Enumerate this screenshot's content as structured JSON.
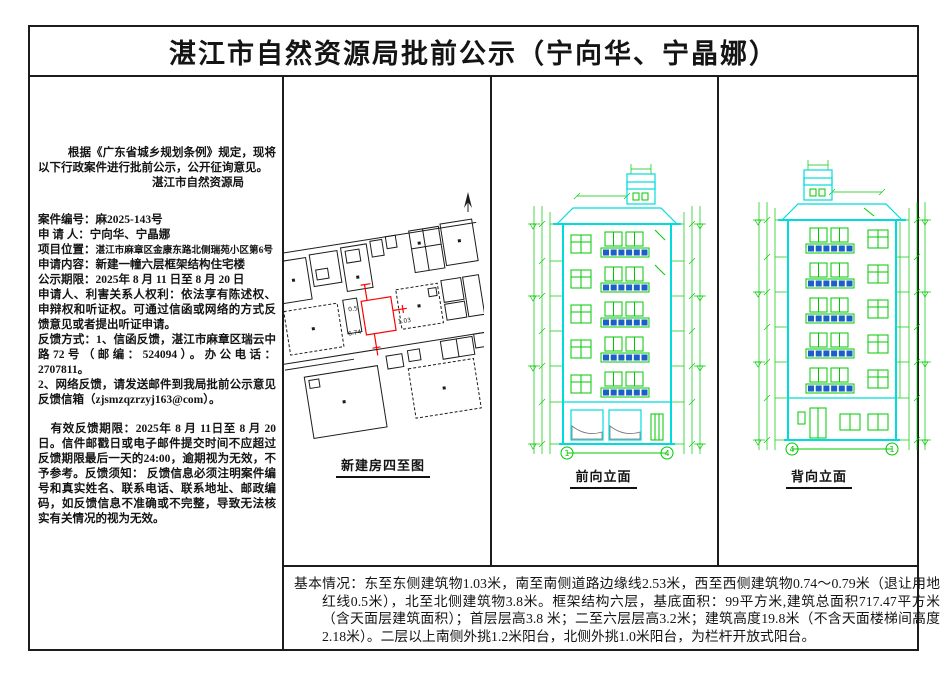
{
  "title": "湛江市自然资源局批前公示（宁向华、宁晶娜）",
  "left_panel": {
    "intro": "根据《广东省城乡规划条例》规定，现将以下行政案件进行批前公示，公开征询意见。",
    "agency": "湛江市自然资源局",
    "fields": [
      {
        "label": "案件编号：",
        "value": "麻2025-143号"
      },
      {
        "label": "申 请 人：",
        "value": "宁向华、宁晶娜"
      },
      {
        "label": "项目位置：",
        "value": "湛江市麻章区金康东路北侧瑞苑小区第6号"
      },
      {
        "label": "申请内容：",
        "value": "新建一幢六层框架结构住宅楼"
      },
      {
        "label": "公示期限：",
        "value": "2025年 8 月 11 日至  8 月 20 日"
      }
    ],
    "rights": "申请人、利害关系人权利：依法享有陈述权、申辩权和听证权。可通过信函或网络的方式反馈意见或者提出听证申请。",
    "feedback_mail": "反馈方式：1、信函反馈，湛江市麻章区瑞云中路72号（邮编：524094）。办公电话：2707811。",
    "feedback_net": "2、网络反馈，请发送邮件到我局批前公示意见反馈信箱（zjsmzqzrzyj163@com）。",
    "deadline": "有效反馈期限：2025年 8 月 11日至 8 月 20 日。信件邮戳日或电子邮件提交时间不应超过反馈期限最后一天的24:00，逾期视为无效，不予参考。反馈须知： 反馈信息必须注明案件编号和真实姓名、联系电话、联系地址、邮政编码，如反馈信息不准确或不完整，导致无法核实有关情况的视为无效。"
  },
  "drawings": {
    "site_plan_label": "新建房四至图",
    "front_label": "前向立面",
    "back_label": "背向立面",
    "front_axis_left": "1",
    "front_axis_right": "4",
    "back_axis_left": "4",
    "back_axis_right": "1",
    "site_dims": {
      "west_setback": "0.5",
      "south_width": "6.74",
      "east_setback": "1.03"
    }
  },
  "basic_info": {
    "label": "基本情况：",
    "text": "东至东侧建筑物1.03米，南至南侧道路边缘线2.53米，西至西侧建筑物0.74～0.79米（退让用地红线0.5米），北至北侧建筑物3.8米。框架结构六层，基底面积：99平方米,建筑总面积717.47平方米（含天面层建筑面积）；首层层高3.8 米；二至六层层高3.2米；建筑高度19.8米（不含天面楼梯间高度2.18米）。二层以上南侧外挑1.2米阳台，北侧外挑1.0米阳台，为栏杆开放式阳台。"
  },
  "colors": {
    "cad_green": "#00c800",
    "cad_cyan": "#00dcdc",
    "cad_red": "#ff0000",
    "cad_blue": "#1b5fc8",
    "border": "#1c1c1c"
  }
}
